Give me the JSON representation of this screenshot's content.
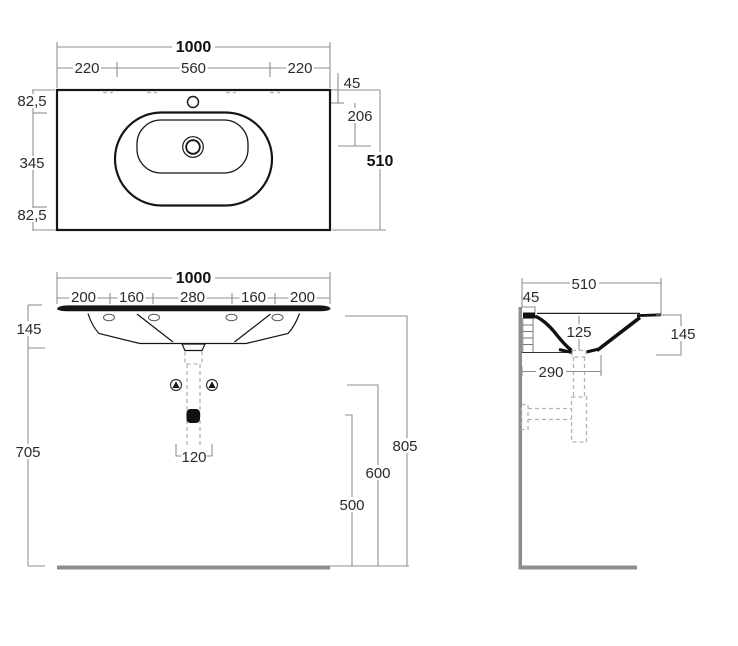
{
  "drawing": {
    "type": "washbasin-technical-drawing",
    "colors": {
      "line": "#151515",
      "dimension": "#8f8f8f",
      "hidden": "#b3b3b3",
      "wall_floor": "#8c8c8c",
      "text": "#2b2b2b"
    },
    "plan": {
      "total_width": "1000",
      "left_span": "220",
      "center_span": "560",
      "right_span": "220",
      "tap_offset": "45",
      "drain_offset": "206",
      "total_depth": "510",
      "edge_offset_top": "82,5",
      "side_span": "345",
      "edge_offset_bottom": "82,5"
    },
    "front": {
      "total_width": "1000",
      "spans": [
        "200",
        "160",
        "280",
        "160",
        "200"
      ],
      "basin_height": "145",
      "floor_clearance": "705",
      "drain_spacing": "120",
      "trap_height": "500",
      "mid_height": "600",
      "rim_height": "805"
    },
    "side": {
      "total_depth": "510",
      "wall_offset": "45",
      "bowl_depth": "125",
      "trap_distance": "290",
      "basin_height": "145"
    }
  }
}
